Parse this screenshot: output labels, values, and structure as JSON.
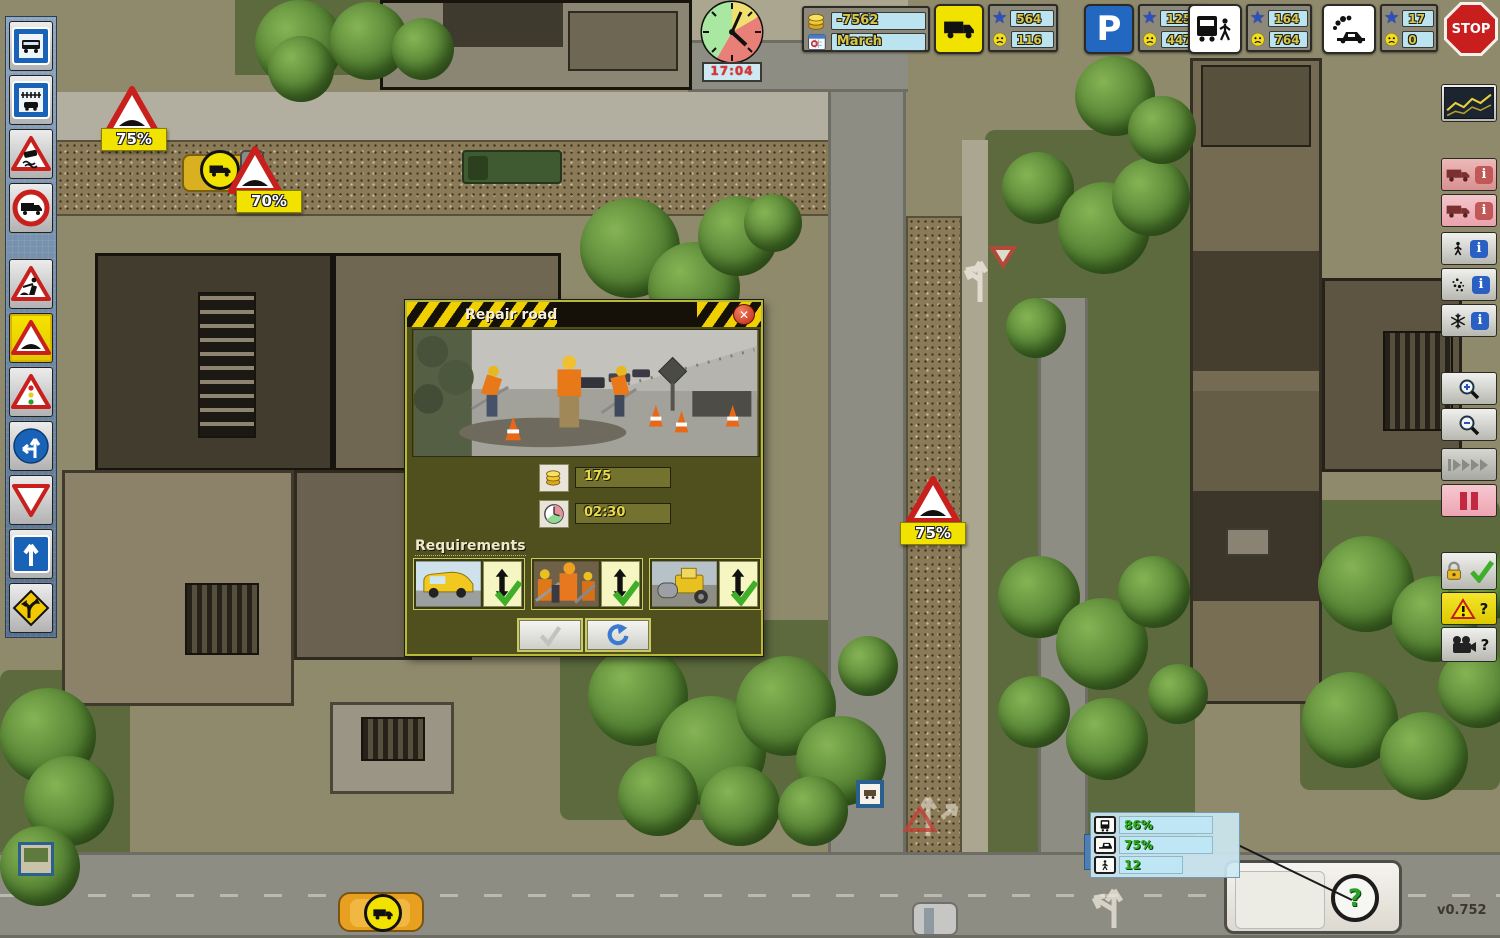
{
  "version_label": "v0.752",
  "hud": {
    "clock": {
      "time": "17:04"
    },
    "money": {
      "amount": "-7562",
      "month": "March"
    },
    "star_glyph": "★",
    "stats": [
      {
        "name": "deliveries",
        "star": "564",
        "unhappy": "116"
      },
      {
        "name": "parking",
        "letter": "P",
        "star": "1253",
        "unhappy": "447"
      },
      {
        "name": "public-transport",
        "star": "164",
        "unhappy": "764"
      },
      {
        "name": "emissions",
        "star": "17",
        "unhappy": "0"
      }
    ],
    "stop_label": "STOP"
  },
  "left_toolbar": {
    "items": [
      {
        "name": "bus-stop-sign"
      },
      {
        "name": "rail-crossing-sign"
      },
      {
        "name": "slippery-road-sign"
      },
      {
        "name": "no-trucks-sign"
      },
      {
        "name": "road-works-sign"
      },
      {
        "name": "speed-bump-sign",
        "selected": true
      },
      {
        "name": "traffic-light-sign"
      },
      {
        "name": "left-or-straight-sign"
      },
      {
        "name": "yield-sign"
      },
      {
        "name": "one-way-sign"
      },
      {
        "name": "curve-warning-sign"
      }
    ]
  },
  "right_toolbar": {
    "info_glyph": "i",
    "question_glyph": "?",
    "items": [
      "statistics-graph",
      "truck-info",
      "truck-info-2",
      "pedestrian-info",
      "emissions-info",
      "winter-info",
      "zoom-in",
      "zoom-out",
      "game-speed",
      "pause",
      "lock-confirm",
      "warning-help",
      "camera-help"
    ]
  },
  "dialog": {
    "title": "Repair road",
    "cost": "175",
    "duration": "02:30",
    "requirements_label": "Requirements",
    "requirements": [
      {
        "name": "service-van",
        "fulfilled": true
      },
      {
        "name": "road-workers",
        "fulfilled": true
      },
      {
        "name": "road-roller",
        "fulfilled": true
      }
    ]
  },
  "map": {
    "speed_signs": [
      {
        "label": "75%"
      },
      {
        "label": "70%"
      },
      {
        "label": "75%"
      }
    ],
    "status_panel": {
      "rows": [
        {
          "icon": "bus-icon",
          "value": "86%"
        },
        {
          "icon": "transport-icon",
          "value": "75%"
        },
        {
          "icon": "pedestrian-icon",
          "value": "12"
        }
      ]
    },
    "bus_query_badge": "?"
  }
}
